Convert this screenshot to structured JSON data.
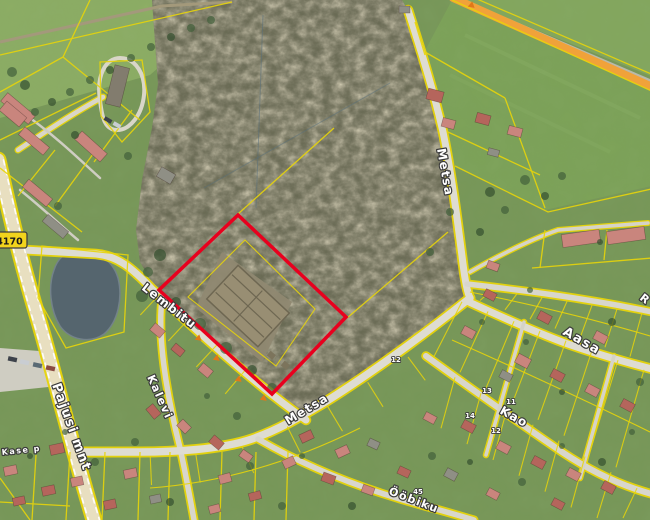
{
  "meta": {
    "title": "Aerial cadastral map with highlighted parcel",
    "width": 650,
    "height": 520
  },
  "colors": {
    "cadastral_line": "#e8d50a",
    "highlight": "#e8001e",
    "orange_road": "#f0a23a",
    "road_fill": "#dcdad0",
    "main_road_fill": "#e8dfc0",
    "minor_road_fill": "#d5d3c8",
    "pond": "#55656e",
    "forest": "#6b6d55",
    "field": "#8fb066",
    "field_right": "#7fa55a",
    "residential": "#7a9a5a",
    "roof_red": "#b5655c",
    "roof_pink": "#c9857d",
    "roof_gray": "#8f8f85",
    "label_fill": "#ffffff",
    "label_halo": "#3a3a3a",
    "badge_bg": "#f2d41c",
    "marker_orange": "#e07818"
  },
  "road_badge": {
    "number": "4170"
  },
  "street_labels": [
    {
      "text": "Lembitu",
      "x": 141,
      "y": 289,
      "rot": 38,
      "size": 12
    },
    {
      "text": "Kalevi",
      "x": 147,
      "y": 377,
      "rot": 66,
      "size": 11
    },
    {
      "text": "Pajusi mnt",
      "x": 52,
      "y": 385,
      "rot": 70,
      "size": 13
    },
    {
      "text": "Metsa",
      "x": 437,
      "y": 149,
      "rot": 80,
      "size": 12
    },
    {
      "text": "Metsa",
      "x": 288,
      "y": 425,
      "rot": -31,
      "size": 12
    },
    {
      "text": "Aasa",
      "x": 562,
      "y": 334,
      "rot": 30,
      "size": 13
    },
    {
      "text": "Kao",
      "x": 499,
      "y": 413,
      "rot": 29,
      "size": 12
    },
    {
      "text": "Ööbiku",
      "x": 388,
      "y": 494,
      "rot": 21,
      "size": 11
    },
    {
      "text": "Kase p",
      "x": 2,
      "y": 455,
      "rot": -6,
      "size": 8
    },
    {
      "text": "R",
      "x": 639,
      "y": 299,
      "rot": 38,
      "size": 11
    }
  ],
  "house_numbers": [
    {
      "text": "13",
      "x": 487,
      "y": 393
    },
    {
      "text": "11",
      "x": 511,
      "y": 404
    },
    {
      "text": "14",
      "x": 470,
      "y": 418
    },
    {
      "text": "12",
      "x": 496,
      "y": 433
    },
    {
      "text": "12",
      "x": 396,
      "y": 362
    },
    {
      "text": "45",
      "x": 418,
      "y": 494
    }
  ],
  "highlight_parcel": {
    "points": "238,215 346,317 272,394 159,290",
    "color": "#e8001e",
    "stroke_width": 3.5
  },
  "address_markers": [
    [
      197,
      337
    ],
    [
      215,
      357
    ],
    [
      237,
      378
    ],
    [
      262,
      397
    ],
    [
      470,
      4
    ]
  ]
}
